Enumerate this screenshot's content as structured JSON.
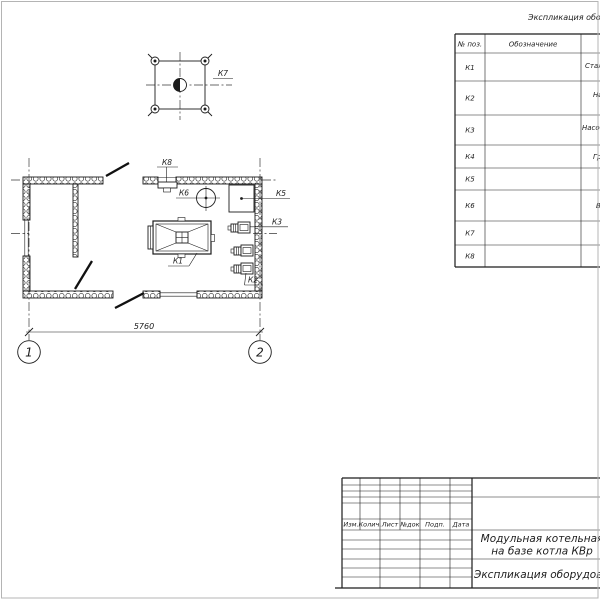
{
  "colors": {
    "line": "#1c1c1c",
    "paper": "#ffffff",
    "border": "#b4b4b4"
  },
  "equipment_table": {
    "title": "Экспликация обору",
    "col_pos_header": "№ поз.",
    "col_designation_header": "Обозначение",
    "rows": [
      {
        "pos": "К1",
        "name": "Стал"
      },
      {
        "pos": "К2",
        "name": "На"
      },
      {
        "pos": "К3",
        "name": "Насос"
      },
      {
        "pos": "К4",
        "name": "Гр"
      },
      {
        "pos": "К5",
        "name": ""
      },
      {
        "pos": "К6",
        "name": "В"
      },
      {
        "pos": "К7",
        "name": ""
      },
      {
        "pos": "К8",
        "name": ""
      }
    ]
  },
  "plan": {
    "labels": {
      "k1": "К1",
      "k2": "К2",
      "k3": "К3",
      "k5": "К5",
      "k6": "К6",
      "k7": "К7",
      "k8": "К8"
    },
    "dimension": "5760",
    "axis_1": "1",
    "axis_2": "2"
  },
  "title_block": {
    "revision_headers": [
      "Изм.",
      "Колич.",
      "Лист",
      "№док",
      "Подп.",
      "Дата"
    ],
    "project_title_line1": "Модульная котельная",
    "project_title_line2": "на базе котла КВр",
    "sheet_title": "Экспликация оборудован"
  }
}
